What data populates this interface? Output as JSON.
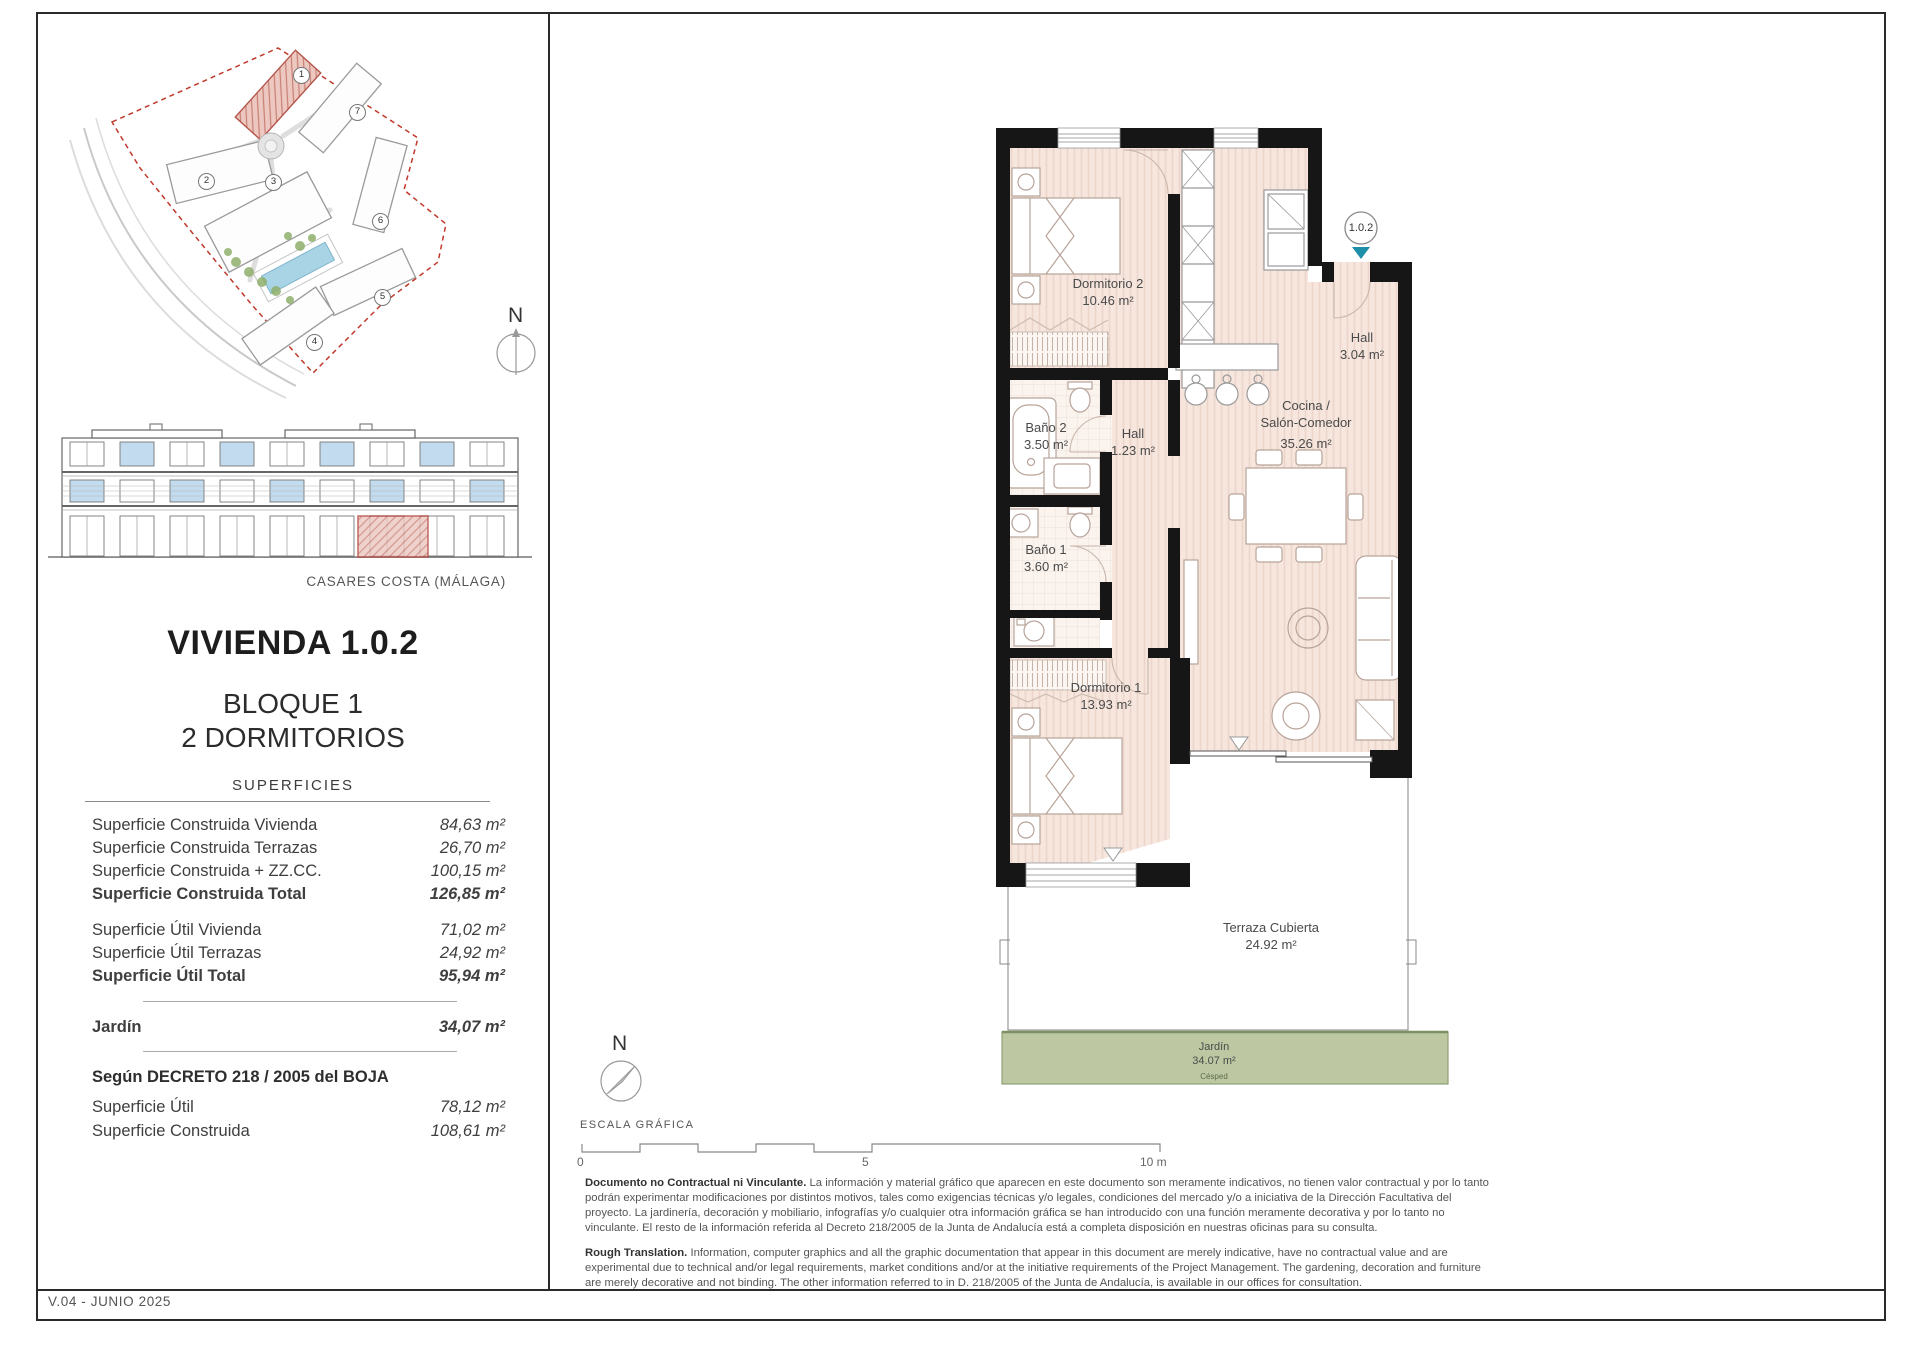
{
  "page": {
    "version": "V.04 - JUNIO 2025",
    "location": "CASARES COSTA (MÁLAGA)"
  },
  "compass": {
    "north": "N"
  },
  "site_plan": {
    "numbers": [
      "1",
      "2",
      "3",
      "4",
      "5",
      "6",
      "7"
    ]
  },
  "title_block": {
    "title": "VIVIENDA 1.0.2",
    "block": "BLOQUE 1",
    "bedrooms": "2 DORMITORIOS",
    "table_title": "SUPERFICIES"
  },
  "surfaces": {
    "construida": [
      {
        "label": "Superficie Construida Vivienda",
        "value": "84,63 m²"
      },
      {
        "label": "Superficie Construida Terrazas",
        "value": "26,70 m²"
      },
      {
        "label": "Superficie Construida + ZZ.CC.",
        "value": "100,15 m²"
      },
      {
        "label": "Superficie Construida Total",
        "value": "126,85 m²"
      }
    ],
    "util": [
      {
        "label": "Superficie Útil Vivienda",
        "value": "71,02 m²"
      },
      {
        "label": "Superficie Útil Terrazas",
        "value": "24,92 m²"
      },
      {
        "label": "Superficie Útil Total",
        "value": "95,94 m²"
      }
    ],
    "jardin": {
      "label": "Jardín",
      "value": "34,07 m²"
    },
    "decreto_title": "Según DECRETO 218 / 2005 del BOJA",
    "decreto": [
      {
        "label": "Superficie Útil",
        "value": "78,12 m²"
      },
      {
        "label": "Superficie Construida",
        "value": "108,61 m²"
      }
    ]
  },
  "floor_plan": {
    "badge": "1.0.2",
    "rooms": [
      {
        "name": "Dormitorio 2",
        "area": "10.46 m²"
      },
      {
        "name": "Baño 2",
        "area": "3.50 m²"
      },
      {
        "name": "Hall",
        "area": "1.23 m²"
      },
      {
        "name": "Baño 1",
        "area": "3.60 m²"
      },
      {
        "name": "Dormitorio 1",
        "area": "13.93 m²"
      },
      {
        "name": "Hall",
        "area": "3.04 m²"
      },
      {
        "name": "Cocina /",
        "name2": "Salón-Comedor",
        "area": "35.26 m²"
      },
      {
        "name": "Terraza Cubierta",
        "area": "24.92 m²"
      },
      {
        "name": "Jardín",
        "area": "34.07 m²",
        "note": "Césped"
      }
    ]
  },
  "scale_bar": {
    "title": "ESCALA GRÁFICA",
    "t0": "0",
    "t5": "5",
    "t10": "10 m"
  },
  "disclaimer": {
    "es_lead": "Documento no Contractual ni Vinculante.",
    "es_body": " La información y material gráfico que aparecen en este documento son meramente indicativos, no tienen valor contractual y por lo tanto podrán experimentar modificaciones por distintos motivos, tales como exigencias técnicas y/o legales, condiciones del mercado y/o a iniciativa de la Dirección Facultativa del proyecto. La jardinería, decoración y mobiliario, infografías y/o cualquier otra información gráfica se han introducido con una función meramente decorativa y por lo tanto no vinculante. El resto de la información referida al Decreto 218/2005 de la Junta de Andalucía está a completa disposición en nuestras oficinas para su consulta.",
    "en_lead": "Rough Translation.",
    "en_body": " Information, computer graphics and all the graphic documentation that appear in this document are merely indicative, have no contractual value and are experimental due to technical and/or legal requirements, market conditions and/or at the initiative requirements of the Project Management. The gardening, decoration and furniture are merely decorative and not binding. The other information referred to in D. 218/2005 of the Junta de Andalucía, is available in our offices for consultation."
  },
  "colors": {
    "accent_teal": "#1e8fa8",
    "boundary_red": "#c0392b",
    "garden_green": "#bdc8a2",
    "glass_blue": "#c3dbee",
    "floor_pink": "#f6e6de"
  }
}
